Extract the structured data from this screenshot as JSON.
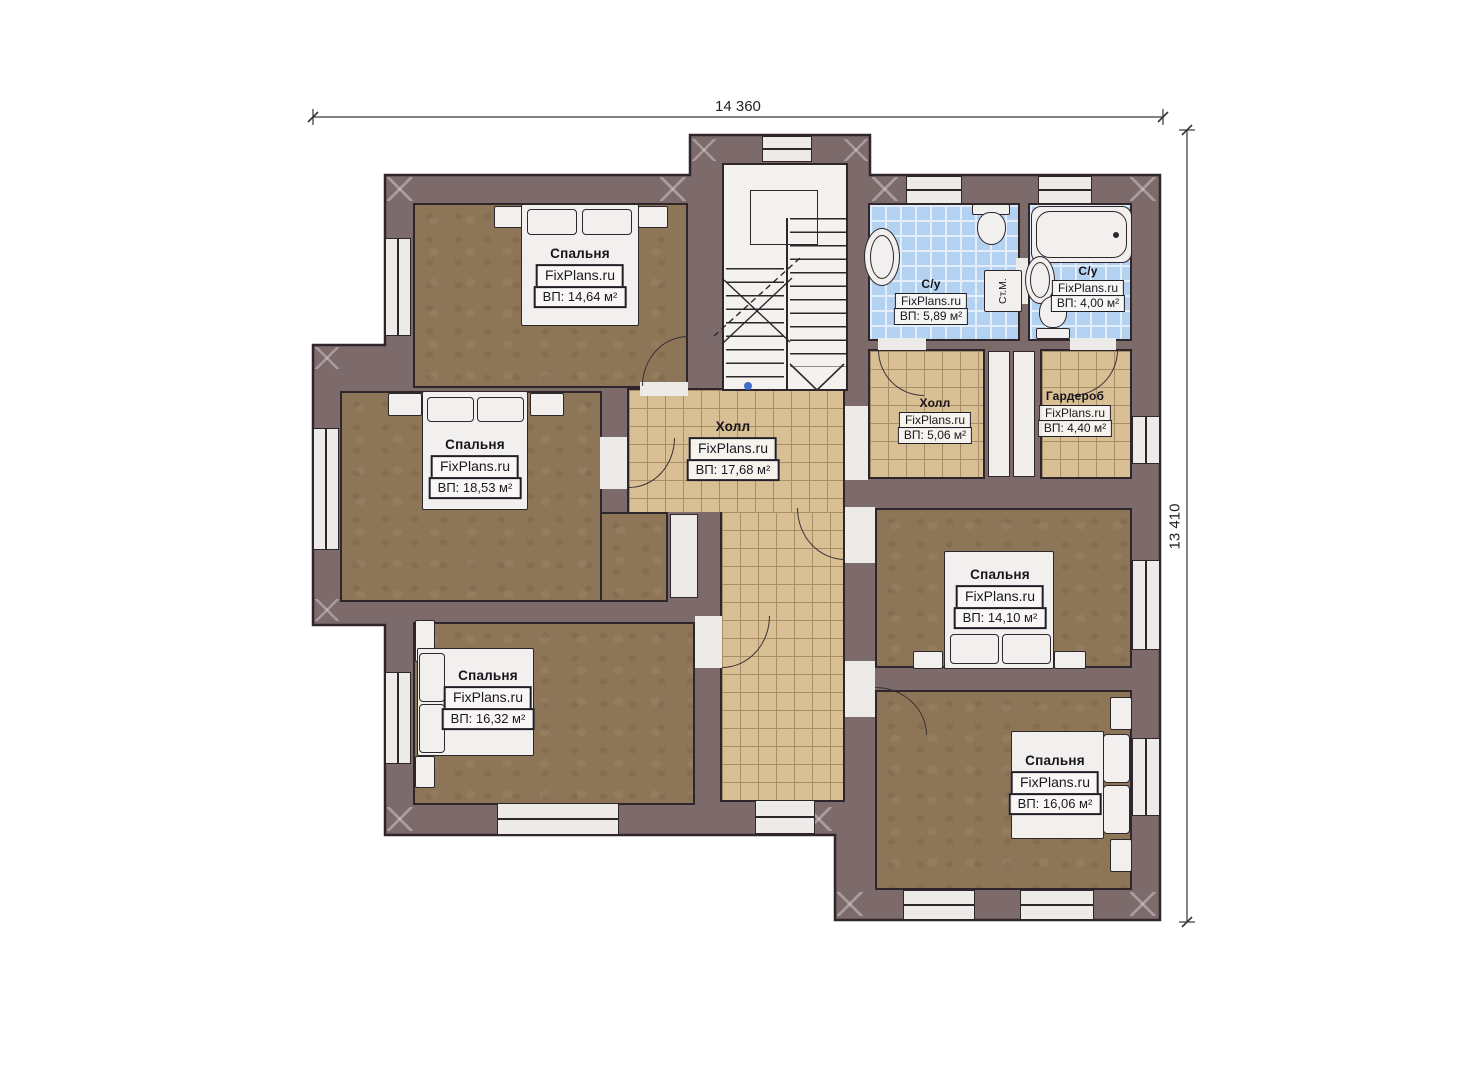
{
  "watermark": "FixPlans.ru",
  "dimensions": {
    "top": "14 360",
    "right": "13 410"
  },
  "rooms": {
    "bedroom_tl": {
      "name": "Спальня",
      "area": "ВП: 14,64 м²"
    },
    "bedroom_ml": {
      "name": "Спальня",
      "area": "ВП: 18,53 м²"
    },
    "bedroom_bl": {
      "name": "Спальня",
      "area": "ВП: 16,32 м²"
    },
    "hall_main": {
      "name": "Холл",
      "area": "ВП: 17,68 м²"
    },
    "hall_small": {
      "name": "Холл",
      "area": "ВП: 5,06 м²"
    },
    "wardrobe": {
      "name": "Гардероб",
      "area": "ВП: 4,40 м²"
    },
    "bath_large": {
      "name": "С/у",
      "area": "ВП: 5,89 м²"
    },
    "bath_small": {
      "name": "С/у",
      "area": "ВП: 4,00 м²"
    },
    "bedroom_mr": {
      "name": "Спальня",
      "area": "ВП: 14,10 м²"
    },
    "bedroom_br": {
      "name": "Спальня",
      "area": "ВП: 16,06 м²"
    }
  },
  "appliances": {
    "washing_machine": "Ст.М."
  },
  "colors": {
    "wall": "#7d6a6b",
    "outline": "#2e262a",
    "floor": "#8d7557",
    "tile": "#d8bf94",
    "tile_line": "#a78e68",
    "bath": "#b3d2f1",
    "bath_line": "#e4eefb",
    "fixture": "#f1f0ee",
    "accent_dot": "#3f6fca"
  }
}
